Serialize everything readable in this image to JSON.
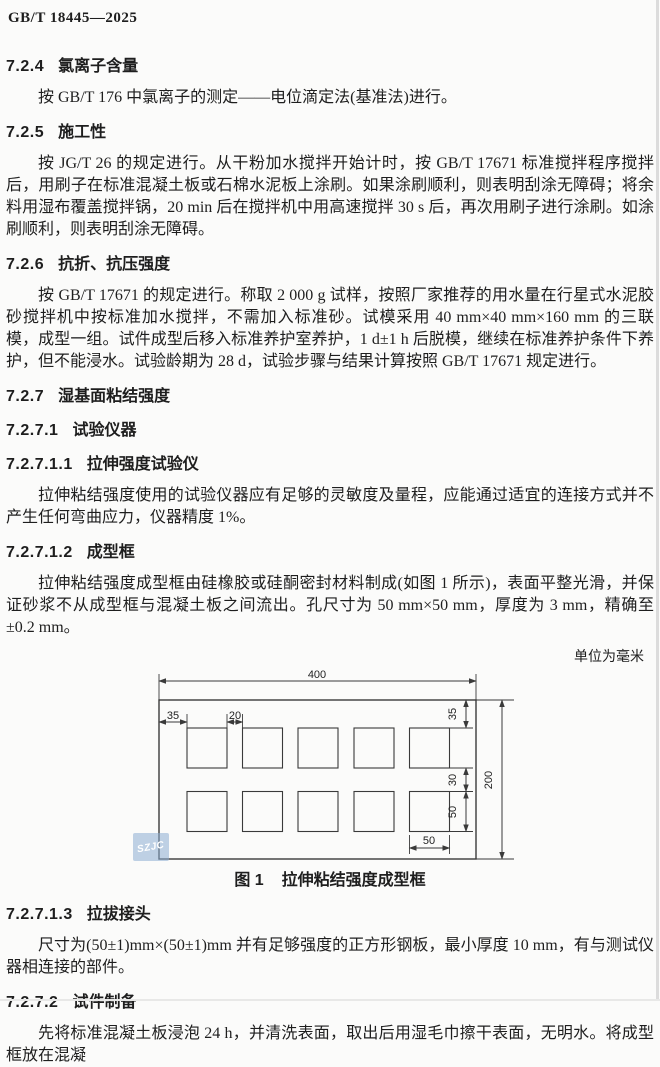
{
  "doc": {
    "header": "GB/T 18445—2025",
    "unit_note": "单位为毫米",
    "watermark": "SZJC"
  },
  "sections": {
    "s724": {
      "num": "7.2.4",
      "title": "氯离子含量",
      "body": "按 GB/T 176 中氯离子的测定——电位滴定法(基准法)进行。"
    },
    "s725": {
      "num": "7.2.5",
      "title": "施工性",
      "body": "按 JG/T 26 的规定进行。从干粉加水搅拌开始计时，按 GB/T 17671 标准搅拌程序搅拌后，用刷子在标准混凝土板或石棉水泥板上涂刷。如果涂刷顺利，则表明刮涂无障碍；将余料用湿布覆盖搅拌锅，20 min 后在搅拌机中用高速搅拌 30 s 后，再次用刷子进行涂刷。如涂刷顺利，则表明刮涂无障碍。"
    },
    "s726": {
      "num": "7.2.6",
      "title": "抗折、抗压强度",
      "body": "按 GB/T 17671 的规定进行。称取 2 000 g 试样，按照厂家推荐的用水量在行星式水泥胶砂搅拌机中按标准加水搅拌，不需加入标准砂。试模采用 40 mm×40 mm×160 mm 的三联模，成型一组。试件成型后移入标准养护室养护，1 d±1 h 后脱模，继续在标准养护条件下养护，但不能浸水。试验龄期为 28 d，试验步骤与结果计算按照 GB/T 17671 规定进行。"
    },
    "s727": {
      "num": "7.2.7",
      "title": "湿基面粘结强度"
    },
    "s7271": {
      "num": "7.2.7.1",
      "title": "试验仪器"
    },
    "s72711": {
      "num": "7.2.7.1.1",
      "title": "拉伸强度试验仪",
      "body": "拉伸粘结强度使用的试验仪器应有足够的灵敏度及量程，应能通过适宜的连接方式并不产生任何弯曲应力，仪器精度 1%。"
    },
    "s72712": {
      "num": "7.2.7.1.2",
      "title": "成型框",
      "body": "拉伸粘结强度成型框由硅橡胶或硅酮密封材料制成(如图 1 所示)，表面平整光滑，并保证砂浆不从成型框与混凝土板之间流出。孔尺寸为 50 mm×50 mm，厚度为 3 mm，精确至±0.2 mm。"
    },
    "s72713": {
      "num": "7.2.7.1.3",
      "title": "拉拔接头",
      "body": "尺寸为(50±1)mm×(50±1)mm 并有足够强度的正方形钢板，最小厚度 10 mm，有与测试仪器相连接的部件。"
    },
    "s7272": {
      "num": "7.2.7.2",
      "title": "试件制备",
      "body": "先将标准混凝土板浸泡 24 h，并清洗表面，取出后用湿毛巾擦干表面，无明水。将成型框放在混凝"
    }
  },
  "figure": {
    "caption_label": "图 1",
    "caption_title": "拉伸粘结强度成型框",
    "hole_rows": 2,
    "holes_per_row": 5,
    "dimensions": {
      "overall_width": "400",
      "overall_height": "200",
      "edge_margin_left": "35",
      "hole_gap": "20",
      "edge_margin_top": "35",
      "row_gap": "30",
      "hole_height": "50",
      "hole_width": "50"
    }
  }
}
